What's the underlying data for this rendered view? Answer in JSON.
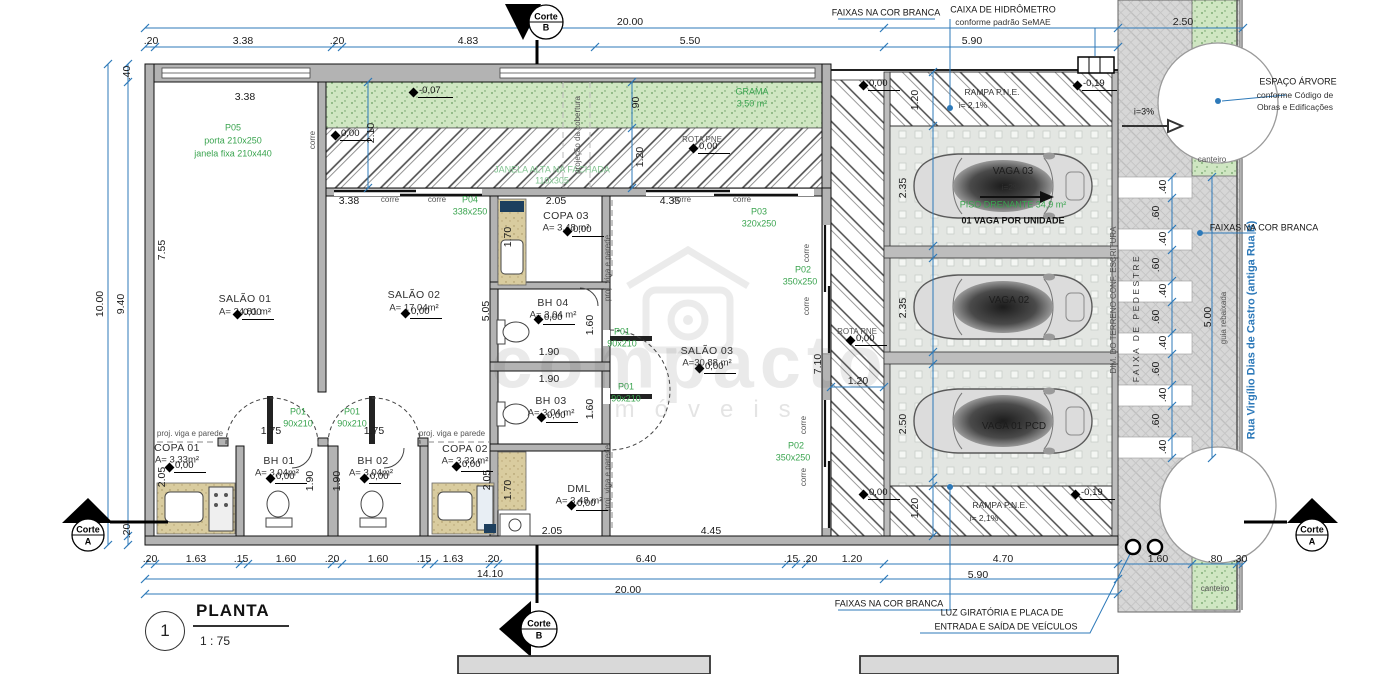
{
  "title_block": {
    "number": "1",
    "name": "PLANTA",
    "scale": "1 : 75"
  },
  "watermark": {
    "line1": "compacto",
    "line2": "imóveis"
  },
  "colors": {
    "dimension_blue": "#2d79b9",
    "spec_green": "#3aa44f",
    "grass_green": "#cfe6c2",
    "wall_gray": "#b3b3b3"
  },
  "labels": [
    {
      "t": "20.00",
      "x": 630,
      "y": 22,
      "c": "d"
    },
    {
      "t": ".20",
      "x": 151,
      "y": 41,
      "c": "d"
    },
    {
      "t": "3.38",
      "x": 243,
      "y": 41,
      "c": "d"
    },
    {
      "t": ".20",
      "x": 337,
      "y": 41,
      "c": "d"
    },
    {
      "t": "4.83",
      "x": 468,
      "y": 41,
      "c": "d"
    },
    {
      "t": "5.50",
      "x": 690,
      "y": 41,
      "c": "d"
    },
    {
      "t": "5.90",
      "x": 972,
      "y": 41,
      "c": "d"
    },
    {
      "t": "2.50",
      "x": 1183,
      "y": 22,
      "c": "d"
    },
    {
      "t": ".40",
      "x": 127,
      "y": 73,
      "c": "d",
      "r": 1
    },
    {
      "t": "10.00",
      "x": 100,
      "y": 304,
      "c": "d",
      "r": 1
    },
    {
      "t": "9.40",
      "x": 121,
      "y": 304,
      "c": "d",
      "r": 1
    },
    {
      "t": "7.55",
      "x": 162,
      "y": 250,
      "c": "d",
      "r": 1
    },
    {
      "t": "2.05",
      "x": 162,
      "y": 477,
      "c": "d",
      "r": 1
    },
    {
      "t": ".20",
      "x": 127,
      "y": 531,
      "c": "d",
      "r": 1
    },
    {
      "t": "3.38",
      "x": 245,
      "y": 97,
      "c": "d"
    },
    {
      "t": "FAIXAS NA COR BRANCA",
      "x": 886,
      "y": 13,
      "c": "n"
    },
    {
      "t": "CAIXA DE HIDRÔMETRO",
      "x": 1003,
      "y": 10,
      "c": "n"
    },
    {
      "t": "conforme padrão SeMAE",
      "x": 1003,
      "y": 22,
      "c": "m"
    },
    {
      "t": "ESPAÇO ÁRVORE",
      "x": 1298,
      "y": 82,
      "c": "n"
    },
    {
      "t": "conforme Código de",
      "x": 1295,
      "y": 95,
      "c": "m"
    },
    {
      "t": "Obras e Edificações",
      "x": 1295,
      "y": 107,
      "c": "m"
    },
    {
      "t": "P05",
      "x": 233,
      "y": 128,
      "c": "g"
    },
    {
      "t": "porta 210x250",
      "x": 233,
      "y": 141,
      "c": "g"
    },
    {
      "t": "janela fixa 210x440",
      "x": 233,
      "y": 154,
      "c": "g"
    },
    {
      "t": "GRAMA",
      "x": 752,
      "y": 92,
      "c": "g"
    },
    {
      "t": "3,50 m²",
      "x": 752,
      "y": 104,
      "c": "g"
    },
    {
      "t": "JANELA ALTA NA FACHADA",
      "x": 552,
      "y": 170,
      "c": "f"
    },
    {
      "t": "110x305",
      "x": 552,
      "y": 181,
      "c": "f"
    },
    {
      "t": "projeção da cobertura",
      "x": 578,
      "y": 135,
      "c": "s",
      "r": 1
    },
    {
      "t": "corre",
      "x": 313,
      "y": 140,
      "c": "s",
      "r": 1
    },
    {
      "t": "ROTA PNE",
      "x": 702,
      "y": 140,
      "c": "s"
    },
    {
      "t": "2.10",
      "x": 371,
      "y": 133,
      "c": "d",
      "r": 1
    },
    {
      "t": ".90",
      "x": 636,
      "y": 104,
      "c": "d",
      "r": 1
    },
    {
      "t": "1.20",
      "x": 640,
      "y": 157,
      "c": "d",
      "r": 1
    },
    {
      "t": "3.38",
      "x": 349,
      "y": 201,
      "c": "d"
    },
    {
      "t": "corre",
      "x": 390,
      "y": 200,
      "c": "s"
    },
    {
      "t": "corre",
      "x": 437,
      "y": 200,
      "c": "s"
    },
    {
      "t": "P04",
      "x": 470,
      "y": 200,
      "c": "g"
    },
    {
      "t": "338x250",
      "x": 470,
      "y": 212,
      "c": "g"
    },
    {
      "t": "2.05",
      "x": 556,
      "y": 201,
      "c": "d"
    },
    {
      "t": "4.35",
      "x": 670,
      "y": 201,
      "c": "d"
    },
    {
      "t": "corre",
      "x": 682,
      "y": 200,
      "c": "s"
    },
    {
      "t": "corre",
      "x": 742,
      "y": 200,
      "c": "s"
    },
    {
      "t": "P03",
      "x": 759,
      "y": 212,
      "c": "g"
    },
    {
      "t": "320x250",
      "x": 759,
      "y": 224,
      "c": "g"
    },
    {
      "t": "SALÃO 01",
      "x": 245,
      "y": 299,
      "c": "R"
    },
    {
      "t": "A= 24.81 m²",
      "x": 245,
      "y": 312,
      "c": "A"
    },
    {
      "t": "SALÃO 02",
      "x": 414,
      "y": 295,
      "c": "R"
    },
    {
      "t": "A= 17.04m²",
      "x": 414,
      "y": 308,
      "c": "A"
    },
    {
      "t": "SALÃO 03",
      "x": 707,
      "y": 351,
      "c": "R"
    },
    {
      "t": "A=30.88 m²",
      "x": 707,
      "y": 363,
      "c": "A"
    },
    {
      "t": "COPA 03",
      "x": 566,
      "y": 216,
      "c": "R"
    },
    {
      "t": "A= 3,48 m²",
      "x": 566,
      "y": 228,
      "c": "A"
    },
    {
      "t": "BH 04",
      "x": 553,
      "y": 303,
      "c": "R"
    },
    {
      "t": "A= 3,04 m²",
      "x": 553,
      "y": 315,
      "c": "A"
    },
    {
      "t": "BH 03",
      "x": 551,
      "y": 401,
      "c": "R"
    },
    {
      "t": "A= 3,04 m²",
      "x": 551,
      "y": 413,
      "c": "A"
    },
    {
      "t": "DML",
      "x": 579,
      "y": 489,
      "c": "R"
    },
    {
      "t": "A= 3,48 m²",
      "x": 579,
      "y": 501,
      "c": "A"
    },
    {
      "t": "COPA 01",
      "x": 177,
      "y": 448,
      "c": "R"
    },
    {
      "t": "A= 3,33m²",
      "x": 177,
      "y": 460,
      "c": "A"
    },
    {
      "t": "BH 01",
      "x": 279,
      "y": 461,
      "c": "R"
    },
    {
      "t": "A= 3,04m²",
      "x": 277,
      "y": 473,
      "c": "A"
    },
    {
      "t": "BH 02",
      "x": 373,
      "y": 461,
      "c": "R"
    },
    {
      "t": "A= 3,04m²",
      "x": 371,
      "y": 473,
      "c": "A"
    },
    {
      "t": "COPA 02",
      "x": 465,
      "y": 449,
      "c": "R"
    },
    {
      "t": "A= 3,33 m²",
      "x": 465,
      "y": 461,
      "c": "A"
    },
    {
      "t": "P02",
      "x": 803,
      "y": 270,
      "c": "g"
    },
    {
      "t": "350x250",
      "x": 800,
      "y": 282,
      "c": "g"
    },
    {
      "t": "P02",
      "x": 796,
      "y": 446,
      "c": "g"
    },
    {
      "t": "350x250",
      "x": 793,
      "y": 458,
      "c": "g"
    },
    {
      "t": "corre",
      "x": 807,
      "y": 253,
      "c": "s",
      "r": 1
    },
    {
      "t": "corre",
      "x": 807,
      "y": 306,
      "c": "s",
      "r": 1
    },
    {
      "t": "corre",
      "x": 804,
      "y": 425,
      "c": "s",
      "r": 1
    },
    {
      "t": "corre",
      "x": 804,
      "y": 477,
      "c": "s",
      "r": 1
    },
    {
      "t": "7.10",
      "x": 818,
      "y": 364,
      "c": "d",
      "r": 1
    },
    {
      "t": "5.05",
      "x": 486,
      "y": 311,
      "c": "d",
      "r": 1
    },
    {
      "t": "1.70",
      "x": 508,
      "y": 237,
      "c": "d",
      "r": 1
    },
    {
      "t": "1.70",
      "x": 508,
      "y": 490,
      "c": "d",
      "r": 1
    },
    {
      "t": "1.60",
      "x": 590,
      "y": 325,
      "c": "d",
      "r": 1
    },
    {
      "t": "1.60",
      "x": 590,
      "y": 409,
      "c": "d",
      "r": 1
    },
    {
      "t": "1.90",
      "x": 549,
      "y": 352,
      "c": "d"
    },
    {
      "t": "1.90",
      "x": 549,
      "y": 379,
      "c": "d"
    },
    {
      "t": "proj. viga e parede",
      "x": 608,
      "y": 268,
      "c": "s",
      "r": 1
    },
    {
      "t": "proj. viga e parede",
      "x": 608,
      "y": 478,
      "c": "s",
      "r": 1
    },
    {
      "t": "P01",
      "x": 622,
      "y": 332,
      "c": "g"
    },
    {
      "t": "90x210",
      "x": 622,
      "y": 344,
      "c": "g"
    },
    {
      "t": "P01",
      "x": 626,
      "y": 387,
      "c": "g"
    },
    {
      "t": "90x210",
      "x": 626,
      "y": 399,
      "c": "g"
    },
    {
      "t": "proj. viga e parede",
      "x": 190,
      "y": 434,
      "c": "s"
    },
    {
      "t": "proj. viga e parede",
      "x": 452,
      "y": 434,
      "c": "s"
    },
    {
      "t": "1.75",
      "x": 271,
      "y": 431,
      "c": "d"
    },
    {
      "t": "1.75",
      "x": 374,
      "y": 431,
      "c": "d"
    },
    {
      "t": "P01",
      "x": 298,
      "y": 412,
      "c": "g"
    },
    {
      "t": "90x210",
      "x": 298,
      "y": 424,
      "c": "g"
    },
    {
      "t": "P01",
      "x": 352,
      "y": 412,
      "c": "g"
    },
    {
      "t": "90x210",
      "x": 352,
      "y": 424,
      "c": "g"
    },
    {
      "t": "1.90",
      "x": 310,
      "y": 481,
      "c": "d",
      "r": 1
    },
    {
      "t": "1.90",
      "x": 337,
      "y": 481,
      "c": "d",
      "r": 1
    },
    {
      "t": "2.05",
      "x": 487,
      "y": 480,
      "c": "d",
      "r": 1
    },
    {
      "t": "2.05",
      "x": 552,
      "y": 531,
      "c": "d"
    },
    {
      "t": "4.45",
      "x": 711,
      "y": 531,
      "c": "d"
    },
    {
      "t": "RAMPA P.N.E.",
      "x": 992,
      "y": 92,
      "c": "m"
    },
    {
      "t": "i= 2,1%",
      "x": 973,
      "y": 105,
      "c": "m"
    },
    {
      "t": "RAMPA P.N.E.",
      "x": 1000,
      "y": 505,
      "c": "m"
    },
    {
      "t": "i= 2,1%",
      "x": 984,
      "y": 518,
      "c": "m"
    },
    {
      "t": "VAGA 03",
      "x": 1013,
      "y": 172,
      "c": "p"
    },
    {
      "t": "i=2%",
      "x": 1011,
      "y": 187,
      "c": "m"
    },
    {
      "t": "PISO DRENANTE 34,9 m²",
      "x": 1013,
      "y": 205,
      "c": "g"
    },
    {
      "t": "01 VAGA POR UNIDADE",
      "x": 1013,
      "y": 221,
      "c": "p2"
    },
    {
      "t": "VAGA 02",
      "x": 1009,
      "y": 301,
      "c": "p"
    },
    {
      "t": "VAGA 01 PCD",
      "x": 1014,
      "y": 427,
      "c": "p"
    },
    {
      "t": "ROTA PNE",
      "x": 857,
      "y": 332,
      "c": "s"
    },
    {
      "t": "1.20",
      "x": 858,
      "y": 381,
      "c": "d"
    },
    {
      "t": "1.20",
      "x": 915,
      "y": 100,
      "c": "d",
      "r": 1
    },
    {
      "t": "2.35",
      "x": 903,
      "y": 188,
      "c": "d",
      "r": 1
    },
    {
      "t": "2.35",
      "x": 903,
      "y": 308,
      "c": "d",
      "r": 1
    },
    {
      "t": "2.50",
      "x": 903,
      "y": 424,
      "c": "d",
      "r": 1
    },
    {
      "t": "1.20",
      "x": 915,
      "y": 508,
      "c": "d",
      "r": 1
    },
    {
      "t": "i=3%",
      "x": 1144,
      "y": 112,
      "c": "n"
    },
    {
      "t": "DIM. DO TERRENO CONF. ESCRITURA",
      "x": 1114,
      "y": 300,
      "c": "s",
      "r": 1
    },
    {
      "t": "FAIXA DE PEDESTRE",
      "x": 1136,
      "y": 318,
      "c": "sp",
      "r": 1
    },
    {
      "t": ".40",
      "x": 1163,
      "y": 187,
      "c": "d",
      "r": 1
    },
    {
      "t": ".60",
      "x": 1156,
      "y": 213,
      "c": "d",
      "r": 1
    },
    {
      "t": ".40",
      "x": 1163,
      "y": 239,
      "c": "d",
      "r": 1
    },
    {
      "t": ".60",
      "x": 1156,
      "y": 265,
      "c": "d",
      "r": 1
    },
    {
      "t": ".40",
      "x": 1163,
      "y": 291,
      "c": "d",
      "r": 1
    },
    {
      "t": ".60",
      "x": 1156,
      "y": 317,
      "c": "d",
      "r": 1
    },
    {
      "t": ".40",
      "x": 1163,
      "y": 343,
      "c": "d",
      "r": 1
    },
    {
      "t": ".60",
      "x": 1156,
      "y": 369,
      "c": "d",
      "r": 1
    },
    {
      "t": ".40",
      "x": 1163,
      "y": 395,
      "c": "d",
      "r": 1
    },
    {
      "t": ".60",
      "x": 1156,
      "y": 421,
      "c": "d",
      "r": 1
    },
    {
      "t": ".40",
      "x": 1163,
      "y": 447,
      "c": "d",
      "r": 1
    },
    {
      "t": "5.00",
      "x": 1208,
      "y": 317,
      "c": "d",
      "r": 1
    },
    {
      "t": "guia rebaixada",
      "x": 1224,
      "y": 318,
      "c": "s",
      "r": 1
    },
    {
      "t": "Rua Virgílio Dias de Castro (antiga Rua B)",
      "x": 1252,
      "y": 330,
      "c": "b",
      "r": 1
    },
    {
      "t": "FAIXAS NA COR BRANCA",
      "x": 1264,
      "y": 228,
      "c": "n"
    },
    {
      "t": "canteiro",
      "x": 1212,
      "y": 160,
      "c": "s"
    },
    {
      "t": "canteiro",
      "x": 1215,
      "y": 589,
      "c": "s"
    },
    {
      "t": ".20",
      "x": 150,
      "y": 559,
      "c": "d"
    },
    {
      "t": "1.63",
      "x": 196,
      "y": 559,
      "c": "d"
    },
    {
      "t": ".15",
      "x": 241,
      "y": 559,
      "c": "d"
    },
    {
      "t": "1.60",
      "x": 286,
      "y": 559,
      "c": "d"
    },
    {
      "t": ".20",
      "x": 332,
      "y": 559,
      "c": "d"
    },
    {
      "t": "1.60",
      "x": 378,
      "y": 559,
      "c": "d"
    },
    {
      "t": ".15",
      "x": 424,
      "y": 559,
      "c": "d"
    },
    {
      "t": "1.63",
      "x": 453,
      "y": 559,
      "c": "d"
    },
    {
      "t": ".20",
      "x": 492,
      "y": 559,
      "c": "d"
    },
    {
      "t": "6.40",
      "x": 646,
      "y": 559,
      "c": "d"
    },
    {
      "t": ".15",
      "x": 791,
      "y": 559,
      "c": "d"
    },
    {
      "t": ".20",
      "x": 810,
      "y": 559,
      "c": "d"
    },
    {
      "t": "1.20",
      "x": 852,
      "y": 559,
      "c": "d"
    },
    {
      "t": "4.70",
      "x": 1003,
      "y": 559,
      "c": "d"
    },
    {
      "t": "1.60",
      "x": 1158,
      "y": 559,
      "c": "d"
    },
    {
      "t": ".80",
      "x": 1215,
      "y": 559,
      "c": "d"
    },
    {
      "t": ".30",
      "x": 1240,
      "y": 559,
      "c": "d"
    },
    {
      "t": "14.10",
      "x": 490,
      "y": 574,
      "c": "d"
    },
    {
      "t": "5.90",
      "x": 978,
      "y": 575,
      "c": "d"
    },
    {
      "t": "20.00",
      "x": 628,
      "y": 590,
      "c": "d"
    },
    {
      "t": "FAIXAS NA COR BRANCA",
      "x": 889,
      "y": 604,
      "c": "n"
    },
    {
      "t": "LUZ GIRATÓRIA E PLACA DE",
      "x": 1002,
      "y": 613,
      "c": "n"
    },
    {
      "t": "ENTRADA E SAÍDA DE VEÍCULOS",
      "x": 1006,
      "y": 627,
      "c": "n"
    },
    {
      "t": "Corte",
      "x": 546,
      "y": 17,
      "c": "k"
    },
    {
      "t": "B",
      "x": 546,
      "y": 28,
      "c": "k"
    },
    {
      "t": "Corte",
      "x": 539,
      "y": 624,
      "c": "k"
    },
    {
      "t": "B",
      "x": 539,
      "y": 636,
      "c": "k"
    },
    {
      "t": "Corte",
      "x": 88,
      "y": 530,
      "c": "k"
    },
    {
      "t": "A",
      "x": 88,
      "y": 542,
      "c": "k"
    },
    {
      "t": "Corte",
      "x": 1312,
      "y": 530,
      "c": "k"
    },
    {
      "t": "A",
      "x": 1312,
      "y": 542,
      "c": "k"
    }
  ],
  "levels": [
    {
      "v": "-0,07",
      "x": 418,
      "y": 97
    },
    {
      "v": "0,00",
      "x": 340,
      "y": 140
    },
    {
      "v": "0,00",
      "x": 698,
      "y": 153
    },
    {
      "v": "0,00",
      "x": 868,
      "y": 90
    },
    {
      "v": "-0,19",
      "x": 1082,
      "y": 90
    },
    {
      "v": "0,00",
      "x": 242,
      "y": 319
    },
    {
      "v": "0,00",
      "x": 410,
      "y": 318
    },
    {
      "v": "0,00",
      "x": 704,
      "y": 373
    },
    {
      "v": "0,00",
      "x": 572,
      "y": 236
    },
    {
      "v": "0,00",
      "x": 543,
      "y": 324
    },
    {
      "v": "0,00",
      "x": 546,
      "y": 422
    },
    {
      "v": "0,00",
      "x": 576,
      "y": 510
    },
    {
      "v": "0,00",
      "x": 174,
      "y": 472
    },
    {
      "v": "0,00",
      "x": 275,
      "y": 483
    },
    {
      "v": "0,00",
      "x": 369,
      "y": 483
    },
    {
      "v": "0,00",
      "x": 461,
      "y": 471
    },
    {
      "v": "0,00",
      "x": 855,
      "y": 345
    },
    {
      "v": "0,00",
      "x": 868,
      "y": 499
    },
    {
      "v": "-0,19",
      "x": 1080,
      "y": 499
    }
  ]
}
